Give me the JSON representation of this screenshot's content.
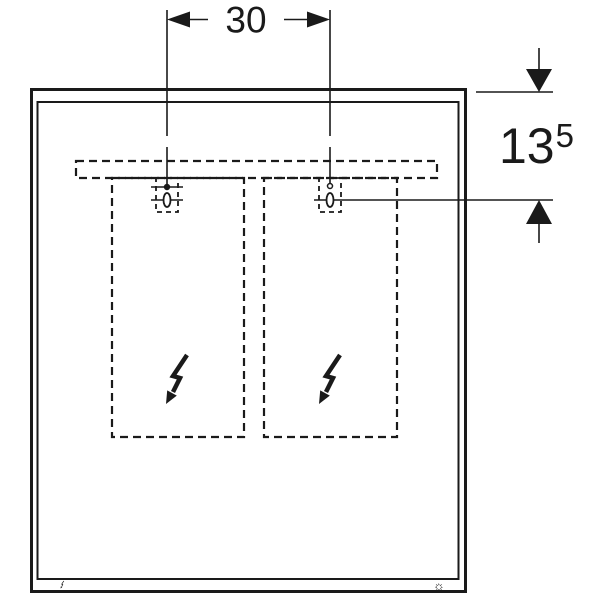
{
  "drawing": {
    "kind": "technical-dimension-drawing",
    "background": "#ffffff",
    "line_color": "#1a1a1a"
  },
  "dimensions": {
    "anchor_spacing": {
      "value": "30"
    },
    "top_offset": {
      "value": "13",
      "superscript": "5"
    }
  },
  "icons": {
    "left_door_symbol": "lightning-bolt-arrow",
    "right_door_symbol": "lightning-bolt-arrow",
    "bottom_left_symbol": "lightning-bolt-arrow-small",
    "bottom_right_symbol": "☼"
  }
}
